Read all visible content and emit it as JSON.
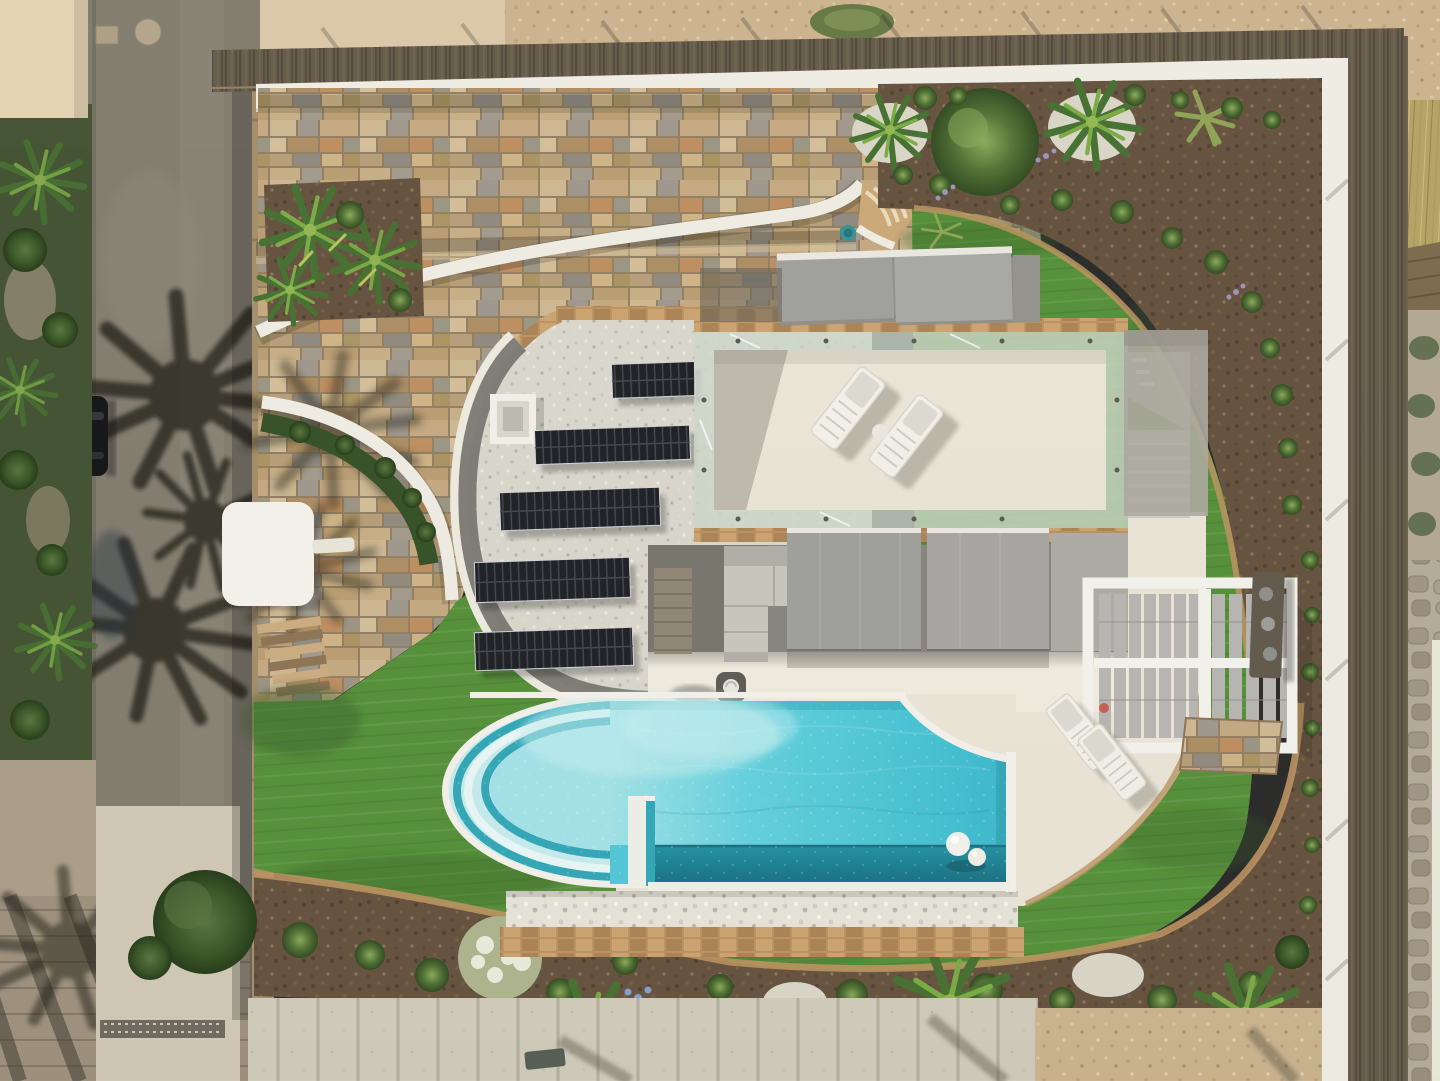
{
  "scene": {
    "caption": "Aerial drone view of a modern white villa: gravel roof with five rows of solar panels, glass-railed roof terrace with two sun loungers and grey awnings, curved turquoise infinity pool with arc steps, white louvered pergola, artificial-lawn loop, mulch gardens with round shrubs and palms, stone mosaic driveway, and a street with palm-tree shadows and a parked black car",
    "palette": {
      "road": "#7e786b",
      "road_shadow": "#211e19",
      "street_wall": "#a08a68",
      "beige_pavement": "#d8c6a6",
      "gravel_top": "#c9b08b",
      "fence": "#5e5545",
      "wall_white": "#efece3",
      "mosaic_base": "#8f7b5e",
      "lawn": "#4f8c32",
      "lawn_dark": "#2c5520",
      "mulch": "#5f4c39",
      "roof_gravel": "#d8d5cb",
      "roof_rim": "#6f6d66",
      "solar": "#16181d",
      "solar_line": "#3c414b",
      "terrace": "#e9e4d6",
      "terrace_bright": "#efeadd",
      "awning": "#9c9c9a",
      "glass": "#ccd6c9",
      "apron": "#a8a59b",
      "pool_light": "#b9ecef",
      "pool_mid": "#56cbdb",
      "pool_deep": "#2fb5ca",
      "pool_trough": "#157a8c",
      "pool_step": "#2aa4b5",
      "rim_white": "#f3f1e9",
      "pebble": "#e6e3d9",
      "stone_trim": "#b98f5c",
      "hedge": "#2e4a20",
      "plank": "#cfc9ba",
      "flag": "#b3a896",
      "dry_grass": "#b3a05f",
      "reed": "#776545",
      "shadow": "#201d17"
    }
  }
}
